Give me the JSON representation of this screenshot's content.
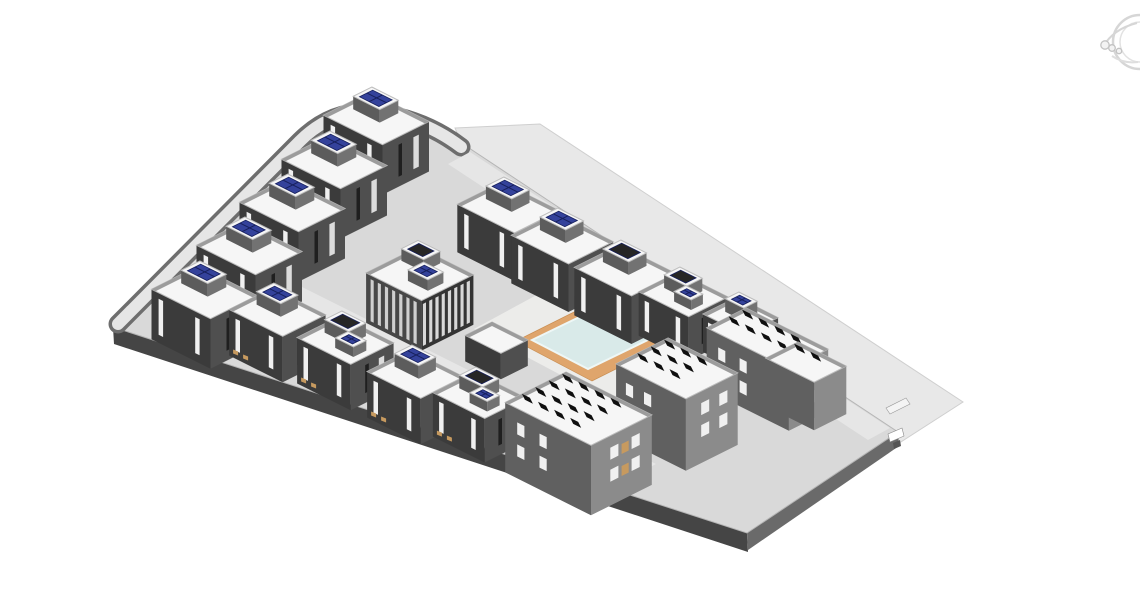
{
  "viewport": {
    "width": 1140,
    "height": 596
  },
  "colors": {
    "background": "#ffffff",
    "plane": "#e8e8e8",
    "plane_edge": "#cfcfcf",
    "podium": "#d9d9d9",
    "podium_line": "#b5b5b5",
    "podium_face_sw": "#454545",
    "podium_face_se": "#6a6a6a",
    "road": "#e6e6e6",
    "road_curb": "#6e6e6e",
    "court": "#ececea",
    "deck": "#dfa56c",
    "deck_edge": "#c98f53",
    "pool": "#d9eae9",
    "pool_edge": "#eef7f6",
    "villa_left": "#3b3b3b",
    "villa_right": "#4f4f4f",
    "roof": "#f6f6f6",
    "roof_edge": "#bdbdbd",
    "parapet": "#9c9c9c",
    "pent_left": "#5c5c5c",
    "pent_right": "#727272",
    "panel_blue": "#34429b",
    "panel_blue_dark": "#17205c",
    "panel_dark": "#262626",
    "block_left": "#606060",
    "block_right": "#8b8b8b",
    "array_black": "#0f0f0f",
    "window_light": "#f0f0f0",
    "window_dark": "#1f1f1f",
    "stripe": "#d8d8d8",
    "clubhouse_face": "#343434",
    "terrace": "#c79a5f",
    "wheel": "#d6d6d6",
    "wheel2": "#c3c3c3"
  },
  "scene": {
    "ground_plane": {
      "points": [
        [
          455,
          128
        ],
        [
          540,
          124
        ],
        [
          963,
          402
        ],
        [
          893,
          447
        ],
        [
          465,
          152
        ]
      ]
    },
    "podium": {
      "path": "M 113,327 L 298,142 Q 330,108 372,110 Q 425,116 466,146 L 898,432 L 747,533 Z",
      "face_sw": [
        [
          113,
          327
        ],
        [
          747,
          533
        ],
        [
          748,
          552
        ],
        [
          114,
          344
        ]
      ],
      "face_se": [
        [
          747,
          533
        ],
        [
          898,
          432
        ],
        [
          899,
          446
        ],
        [
          748,
          550
        ]
      ]
    },
    "curved_road": {
      "path": "M 118,324 L 300,141 Q 331,110 372,112 Q 423,118 461,147",
      "curb_width": 19,
      "width": 12
    },
    "roads": [
      {
        "name": "road-internal",
        "points": [
          [
            232,
            252
          ],
          [
            656,
            464
          ],
          [
            635,
            475
          ],
          [
            211,
            263
          ]
        ]
      },
      {
        "name": "road-northeast",
        "points": [
          [
            470,
            152
          ],
          [
            890,
            428
          ],
          [
            868,
            440
          ],
          [
            448,
            164
          ]
        ]
      }
    ],
    "courtyard": {
      "points": [
        [
          568,
          278
        ],
        [
          702,
          349
        ],
        [
          608,
          400
        ],
        [
          474,
          329
        ]
      ]
    },
    "pool_deck": {
      "points": [
        [
          600,
          299
        ],
        [
          676,
          339
        ],
        [
          592,
          381
        ],
        [
          516,
          341
        ]
      ]
    },
    "pool": {
      "points": [
        [
          598,
          308
        ],
        [
          654,
          337
        ],
        [
          588,
          369
        ],
        [
          532,
          340
        ]
      ]
    },
    "corner_details": [
      {
        "points": [
          [
            886,
            408
          ],
          [
            906,
            398
          ],
          [
            910,
            404
          ],
          [
            890,
            414
          ]
        ],
        "fill": "#f4f4f4",
        "stroke": "#999999"
      },
      {
        "points": [
          [
            888,
            434
          ],
          [
            902,
            428
          ],
          [
            904,
            436
          ],
          [
            890,
            442
          ]
        ],
        "fill": "#ffffff",
        "stroke": "#888888"
      },
      {
        "points": [
          [
            893,
            443
          ],
          [
            900,
            440
          ],
          [
            901,
            446
          ],
          [
            894,
            449
          ]
        ],
        "fill": "#555555",
        "stroke": "none"
      }
    ],
    "buildings": [
      {
        "name": "villa-back-1",
        "type": "villa",
        "x": 370,
        "y": 92,
        "la": 66,
        "lb": 52,
        "h": 50,
        "panel": "blue"
      },
      {
        "name": "villa-back-2",
        "type": "villa",
        "x": 328,
        "y": 136,
        "la": 66,
        "lb": 52,
        "h": 50,
        "panel": "blue"
      },
      {
        "name": "villa-back-3",
        "type": "villa",
        "x": 286,
        "y": 179,
        "la": 66,
        "lb": 52,
        "h": 50,
        "panel": "blue"
      },
      {
        "name": "villa-back-4",
        "type": "villa",
        "x": 243,
        "y": 222,
        "la": 66,
        "lb": 52,
        "h": 50,
        "panel": "blue"
      },
      {
        "name": "villa-back-5",
        "type": "villa",
        "x": 198,
        "y": 266,
        "la": 66,
        "lb": 52,
        "h": 50,
        "panel": "blue"
      },
      {
        "name": "villa-front-1",
        "type": "villa",
        "x": 272,
        "y": 288,
        "la": 60,
        "lb": 48,
        "h": 46,
        "panel": "blue",
        "terrace": true
      },
      {
        "name": "villa-front-2",
        "type": "villa",
        "x": 340,
        "y": 316,
        "la": 60,
        "lb": 48,
        "h": 46,
        "panel": "dark",
        "panel2": "blue",
        "terrace": true
      },
      {
        "name": "villa-front-3",
        "type": "villa",
        "x": 410,
        "y": 350,
        "la": 60,
        "lb": 48,
        "h": 46,
        "panel": "blue",
        "terrace": true
      },
      {
        "name": "villa-front-4",
        "type": "villa",
        "x": 474,
        "y": 372,
        "la": 58,
        "lb": 46,
        "h": 44,
        "panel": "dark",
        "panel2": "blue",
        "terrace": true
      },
      {
        "name": "villa-mid-1",
        "type": "villa",
        "x": 502,
        "y": 182,
        "la": 64,
        "lb": 50,
        "h": 48,
        "panel": "blue"
      },
      {
        "name": "villa-mid-2",
        "type": "villa",
        "x": 556,
        "y": 213,
        "la": 64,
        "lb": 50,
        "h": 48,
        "panel": "blue"
      },
      {
        "name": "villa-mid-3",
        "type": "villa",
        "x": 619,
        "y": 245,
        "la": 64,
        "lb": 50,
        "h": 48,
        "panel": "dark"
      },
      {
        "name": "villa-mid-4",
        "type": "villa",
        "x": 678,
        "y": 272,
        "la": 56,
        "lb": 44,
        "h": 44,
        "panel": "dark",
        "panel2": "blue"
      },
      {
        "name": "villa-right-1",
        "type": "villa",
        "x": 737,
        "y": 297,
        "la": 46,
        "lb": 38,
        "h": 38,
        "panel": "blue"
      },
      {
        "name": "clubhouse",
        "type": "clubhouse",
        "x": 418,
        "y": 247,
        "la": 62,
        "lb": 58,
        "h": 50
      },
      {
        "name": "pool-cabana",
        "type": "cabana",
        "x": 492,
        "y": 322,
        "la": 40,
        "lb": 30,
        "h": 26
      },
      {
        "name": "apartment-block-south",
        "type": "block",
        "x": 566,
        "y": 372,
        "la": 96,
        "lb": 68,
        "h": 70,
        "windows": true,
        "balcony": true
      },
      {
        "name": "apartment-block-center",
        "type": "block",
        "x": 668,
        "y": 338,
        "la": 78,
        "lb": 58,
        "h": 72,
        "windows": true
      },
      {
        "name": "apartment-slab-east",
        "type": "block",
        "x": 746,
        "y": 308,
        "la": 92,
        "lb": 44,
        "h": 62,
        "windows": true
      },
      {
        "name": "apartment-slab-far-east",
        "type": "block",
        "x": 798,
        "y": 342,
        "la": 54,
        "lb": 36,
        "h": 48
      }
    ],
    "navigation_wheel": {
      "cx": 1140,
      "cy": 42,
      "r_outer": 27,
      "r_inner": 20,
      "satellites": [
        [
          1105,
          45,
          4.2
        ],
        [
          1112,
          48,
          3.3
        ],
        [
          1119,
          51,
          2.7
        ]
      ]
    }
  }
}
